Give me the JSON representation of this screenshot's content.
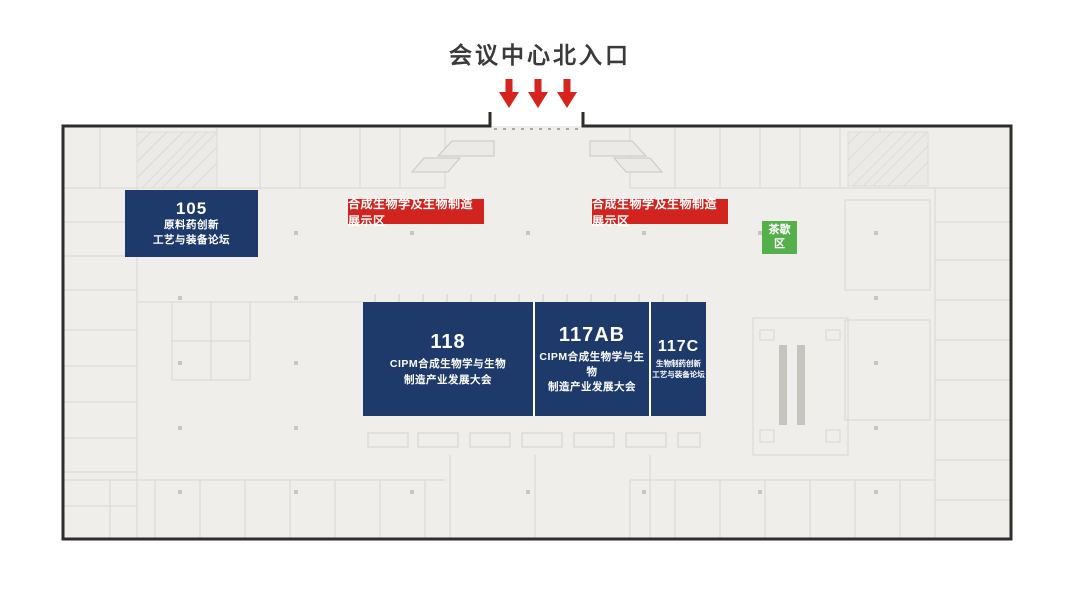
{
  "title": "会议中心北入口",
  "entrance": {
    "arrow_count": 3
  },
  "colors": {
    "navy": "#1e3a6a",
    "red": "#d2241e",
    "green": "#55b04c",
    "wall": "#2e2d2b",
    "plan_background": "#efeeeb",
    "plan_line": "#d9d7d0",
    "title_text": "#3a3a3a"
  },
  "rooms": [
    {
      "id": "105",
      "line1": "原料药创新",
      "line2": "工艺与装备论坛"
    },
    {
      "id": "118",
      "line1": "CIPM合成生物学与生物",
      "line2": "制造产业发展大会"
    },
    {
      "id": "117AB",
      "line1": "CIPM合成生物学与生物",
      "line2": "制造产业发展大会"
    },
    {
      "id": "117C",
      "line1": "生物制药创新",
      "line2": "工艺与装备论坛"
    }
  ],
  "banners": [
    {
      "text": "合成生物学及生物制造展示区"
    },
    {
      "text": "合成生物学及生物制造展示区"
    }
  ],
  "tea_break": {
    "line1": "茶歇",
    "line2": "区"
  }
}
